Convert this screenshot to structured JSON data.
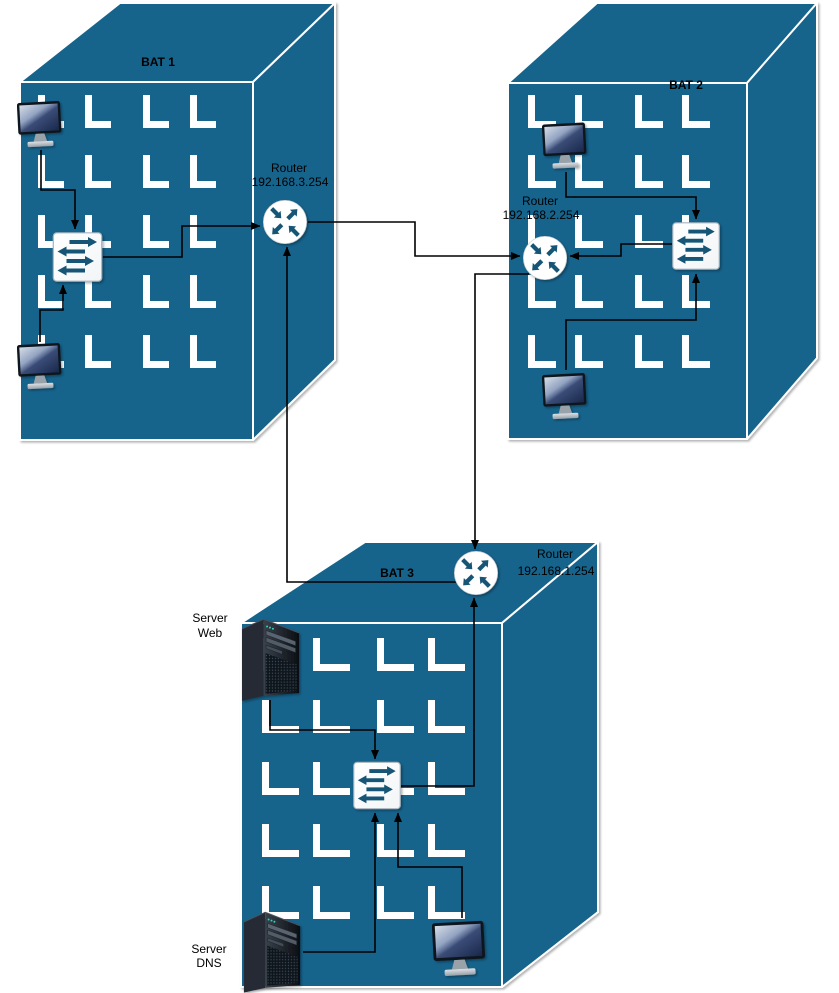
{
  "diagram": {
    "type": "network-topology",
    "description": "Three buildings with routers in a triangle, switches, workstations and servers"
  },
  "buildings": [
    {
      "id": "bat1",
      "label": "BAT 1"
    },
    {
      "id": "bat2",
      "label": "BAT 2"
    },
    {
      "id": "bat3",
      "label": "BAT 3"
    }
  ],
  "routers": [
    {
      "label": "Router",
      "ip": "192.168.3.254",
      "building": "BAT 1"
    },
    {
      "label": "Router",
      "ip": "192.168.2.254",
      "building": "BAT 2"
    },
    {
      "label": "Router",
      "ip": "192.168.1.254",
      "building": "BAT 3"
    }
  ],
  "switches": [
    {
      "building": "BAT 1"
    },
    {
      "building": "BAT 2"
    },
    {
      "building": "BAT 3"
    }
  ],
  "servers": [
    {
      "line1": "Server",
      "line2": "Web",
      "building": "BAT 3"
    },
    {
      "line1": "Server",
      "line2": "DNS",
      "building": "BAT 3"
    }
  ],
  "workstations": [
    {
      "id": "workstation-1-bat1",
      "building": "BAT 1"
    },
    {
      "id": "workstation-2-bat1",
      "building": "BAT 1"
    },
    {
      "id": "workstation-1-bat2",
      "building": "BAT 2"
    },
    {
      "id": "workstation-2-bat2",
      "building": "BAT 2"
    },
    {
      "id": "workstation-bat3",
      "building": "BAT 3"
    }
  ],
  "connections": [
    {
      "from": "workstation-1-bat1",
      "to": "switch-bat1"
    },
    {
      "from": "workstation-2-bat1",
      "to": "switch-bat1"
    },
    {
      "from": "switch-bat1",
      "to": "router-bat1"
    },
    {
      "from": "router-bat1",
      "to": "router-bat2"
    },
    {
      "from": "router-bat2",
      "to": "router-bat3"
    },
    {
      "from": "router-bat3",
      "to": "router-bat1"
    },
    {
      "from": "workstation-1-bat2",
      "to": "switch-bat2"
    },
    {
      "from": "workstation-2-bat2",
      "to": "switch-bat2"
    },
    {
      "from": "switch-bat2",
      "to": "router-bat2"
    },
    {
      "from": "server-web",
      "to": "switch-bat3"
    },
    {
      "from": "server-dns",
      "to": "switch-bat3"
    },
    {
      "from": "workstation-bat3",
      "to": "switch-bat3"
    },
    {
      "from": "switch-bat3",
      "to": "router-bat3"
    }
  ],
  "icons": {
    "router": "circle-with-four-crossing-arrows",
    "switch": "square-with-alternating-horizontal-arrows",
    "workstation": "desktop-monitor",
    "server": "tower-server"
  },
  "colors": {
    "building_fill": "#16648C",
    "building_edge": "#ffffff",
    "icon_accent": "#135574",
    "icon_bg": "#ffffff",
    "connector": "#000000",
    "text": "#000000",
    "canvas_bg": "#ffffff"
  }
}
